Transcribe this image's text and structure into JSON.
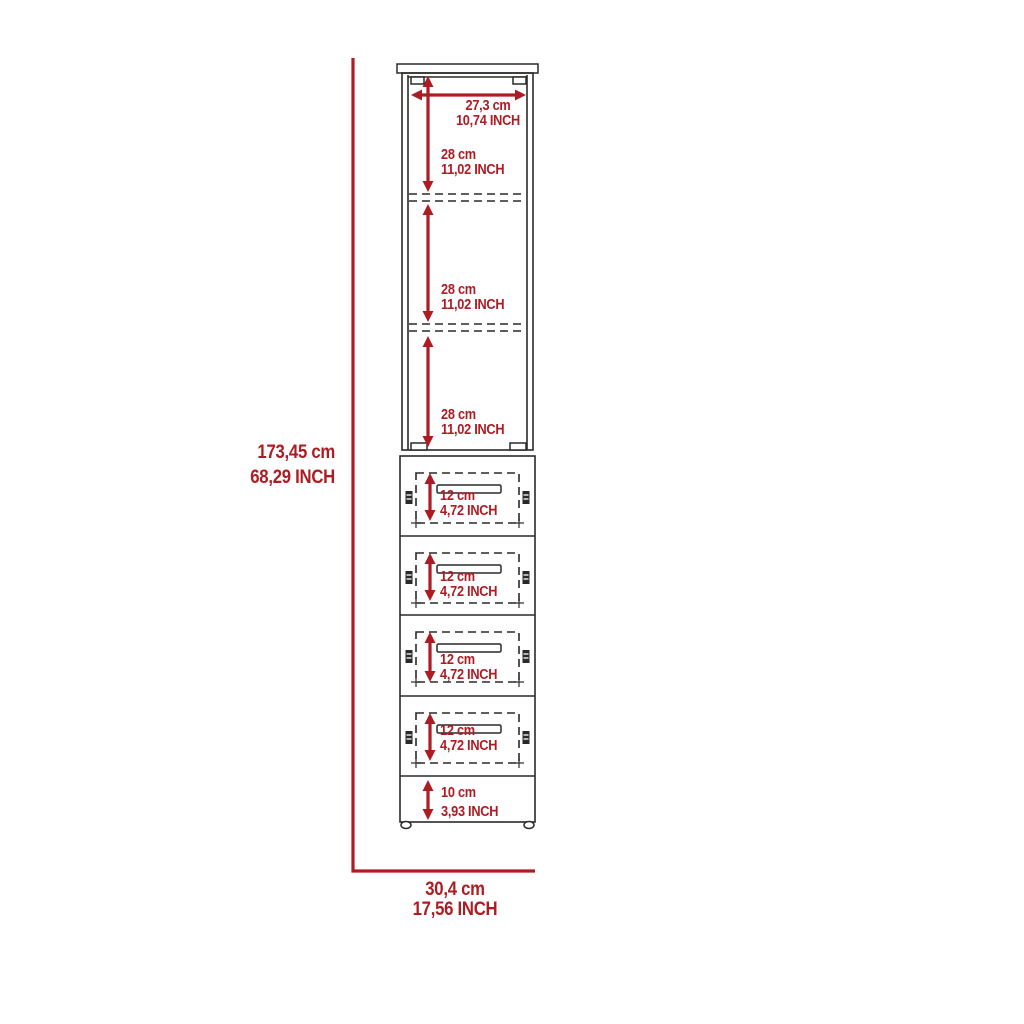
{
  "colors": {
    "background": "#ffffff",
    "line": "#2b2a29",
    "accent_red": "#ae1c23"
  },
  "diagram": {
    "overall_height": {
      "cm": "173,45 cm",
      "inch": "68,29 INCH"
    },
    "overall_width": {
      "cm": "30,4 cm",
      "inch": "17,56 INCH"
    },
    "cabinet_inner_width": {
      "cm": "27,3 cm",
      "inch": "10,74 INCH"
    },
    "shelf_sections": [
      {
        "cm": "28 cm",
        "inch": "11,02 INCH"
      },
      {
        "cm": "28 cm",
        "inch": "11,02 INCH"
      },
      {
        "cm": "28 cm",
        "inch": "11,02 INCH"
      }
    ],
    "drawers": [
      {
        "cm": "12 cm",
        "inch": "4,72 INCH"
      },
      {
        "cm": "12 cm",
        "inch": "4,72 INCH"
      },
      {
        "cm": "12 cm",
        "inch": "4,72 INCH"
      },
      {
        "cm": "12 cm",
        "inch": "4,72 INCH"
      }
    ],
    "base_height": {
      "cm": "10 cm",
      "inch": "3,93 INCH"
    }
  }
}
